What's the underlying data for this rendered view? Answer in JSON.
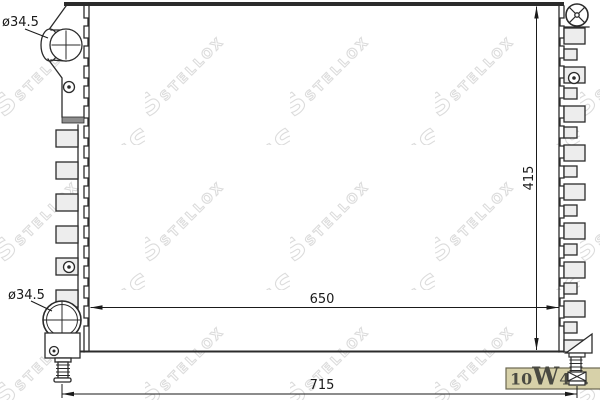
{
  "watermark": {
    "letter": "S",
    "text": "STELLOX",
    "color": "#dcdcdc"
  },
  "dimensions": {
    "top_pipe_diameter": "ø34.5",
    "bottom_pipe_diameter": "ø34.5",
    "core_width": "650",
    "overall_width": "715",
    "core_height": "415"
  },
  "logo": {
    "part1": "10",
    "part2": "W",
    "part3": "40",
    "part4": ".",
    "background": "#d7d1a9",
    "text_color": "#4a4a42",
    "border_color": "#6b6750"
  },
  "line_color": "#2b2b2b"
}
